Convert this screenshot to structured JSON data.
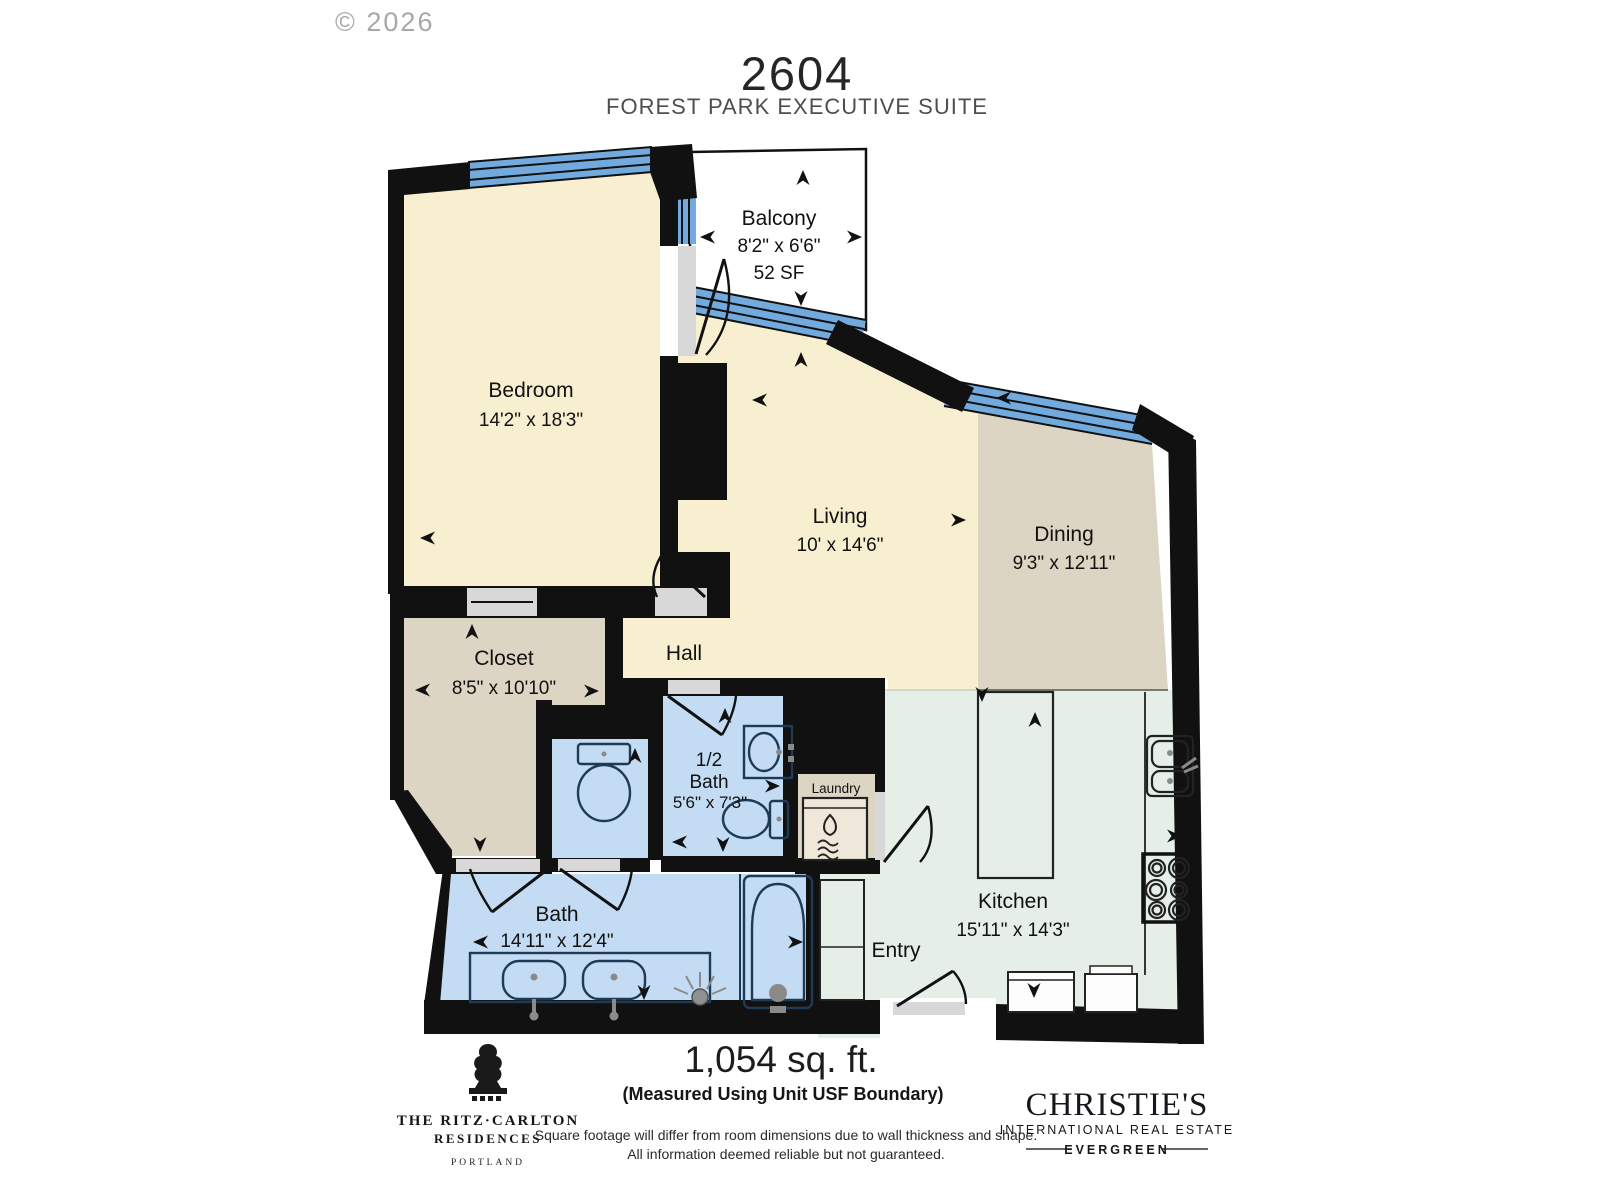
{
  "watermark": {
    "copyright": "© 2026"
  },
  "header": {
    "unit_number": "2604",
    "suite_name": "FOREST PARK EXECUTIVE SUITE"
  },
  "rooms": {
    "balcony": {
      "name": "Balcony",
      "dimensions": "8'2\" x 6'6\"",
      "area": "52 SF"
    },
    "bedroom": {
      "name": "Bedroom",
      "dimensions": "14'2\" x 18'3\""
    },
    "living": {
      "name": "Living",
      "dimensions": "10' x 14'6\""
    },
    "dining": {
      "name": "Dining",
      "dimensions": "9'3\" x 12'11\""
    },
    "closet": {
      "name": "Closet",
      "dimensions": "8'5\" x 10'10\""
    },
    "hall": {
      "name": "Hall"
    },
    "half_bath": {
      "name_line1": "1/2",
      "name_line2": "Bath",
      "dimensions": "5'6\" x 7'3\""
    },
    "laundry": {
      "name": "Laundry"
    },
    "bath": {
      "name": "Bath",
      "dimensions": "14'11\" x 12'4\""
    },
    "kitchen": {
      "name": "Kitchen",
      "dimensions": "15'11\" x 14'3\""
    },
    "entry": {
      "name": "Entry"
    }
  },
  "footer": {
    "total_area": "1,054 sq. ft.",
    "measurement_note": "(Measured Using Unit USF Boundary)",
    "disclaimer_line1": "Square footage will differ from room dimensions due to wall thickness and shape.",
    "disclaimer_line2": "All information deemed reliable but not guaranteed."
  },
  "branding": {
    "ritz": {
      "line1": "THE RITZ·CARLTON",
      "line2": "RESIDENCES",
      "line3": "PORTLAND"
    },
    "christies": {
      "line1": "CHRISTIE'S",
      "line2": "INTERNATIONAL REAL ESTATE",
      "line3": "EVERGREEN"
    }
  },
  "colors": {
    "wall": "#111111",
    "cream_room": "#f8efd1",
    "tan_room": "#ddd5c3",
    "blue_room": "#c3dcf4",
    "mint_room": "#e5efe7",
    "window_blue": "#72aadd",
    "threshold_gray": "#d8d8d8",
    "fixture_outline": "#1e3a56",
    "watermark_gray": "#9a9a9a"
  }
}
